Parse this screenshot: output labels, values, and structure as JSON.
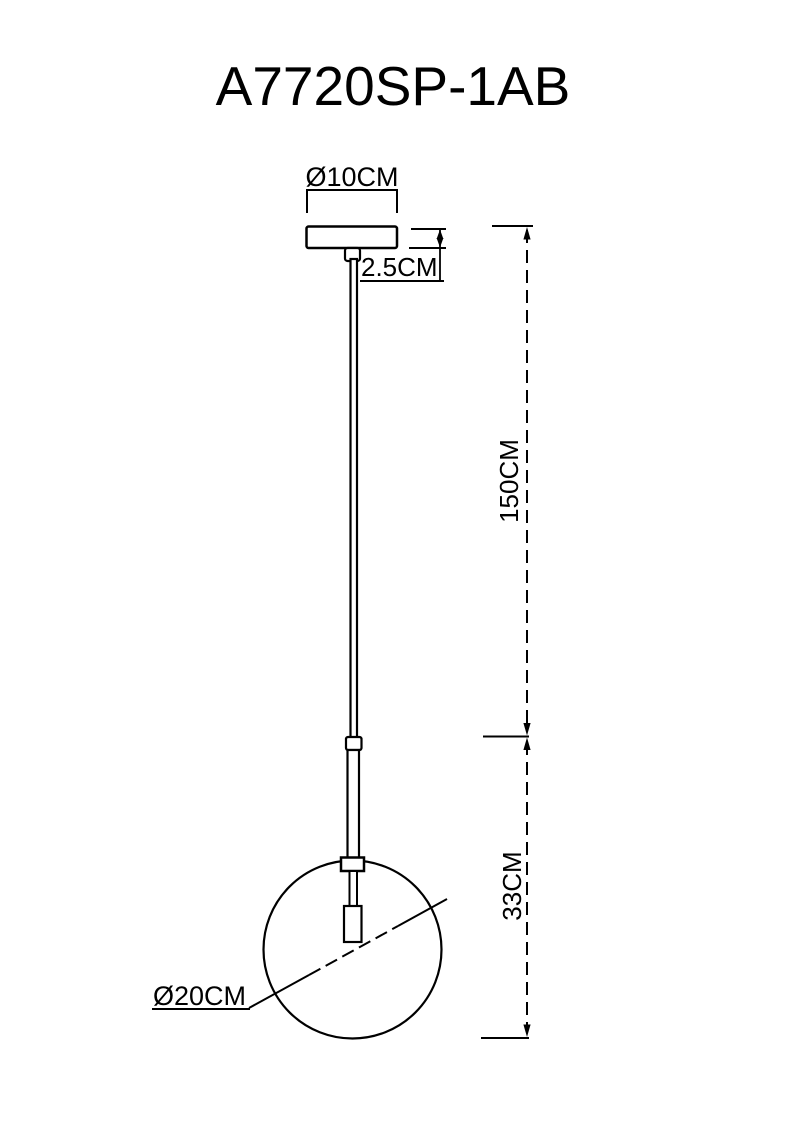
{
  "title": "A7720SP-1AB",
  "diagram": {
    "type": "pendant-lamp-dimension-drawing",
    "labels": {
      "canopy_diameter": "Ø10CM",
      "canopy_height": "2.5CM",
      "rod_length": "150CM",
      "lower_section_height": "33CM",
      "globe_diameter": "Ø20CM"
    },
    "dimensions_cm": {
      "canopy_diameter": 10,
      "canopy_height": 2.5,
      "rod_length": 150,
      "lower_section_height": 33,
      "globe_diameter": 20
    },
    "colors": {
      "line": "#000000",
      "background": "#ffffff"
    }
  }
}
